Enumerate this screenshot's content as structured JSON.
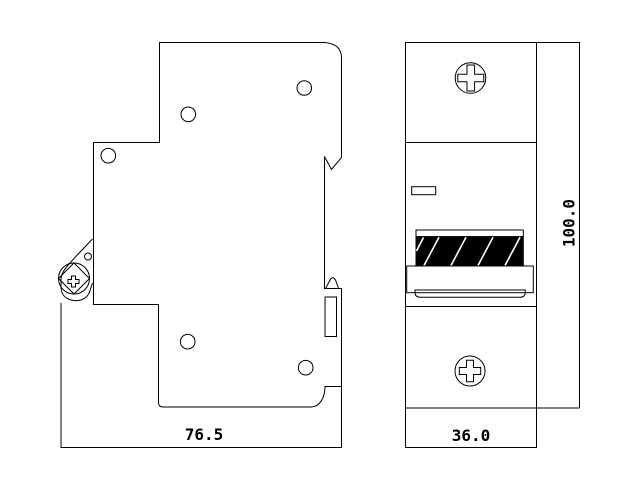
{
  "colors": {
    "line": "#000000",
    "background": "#ffffff",
    "handle_fill": "#000000",
    "hatch": "#ffffff"
  },
  "side_view": {
    "width_label": "76.5"
  },
  "front_view": {
    "width_label": "36.0",
    "height_label": "100.0"
  }
}
